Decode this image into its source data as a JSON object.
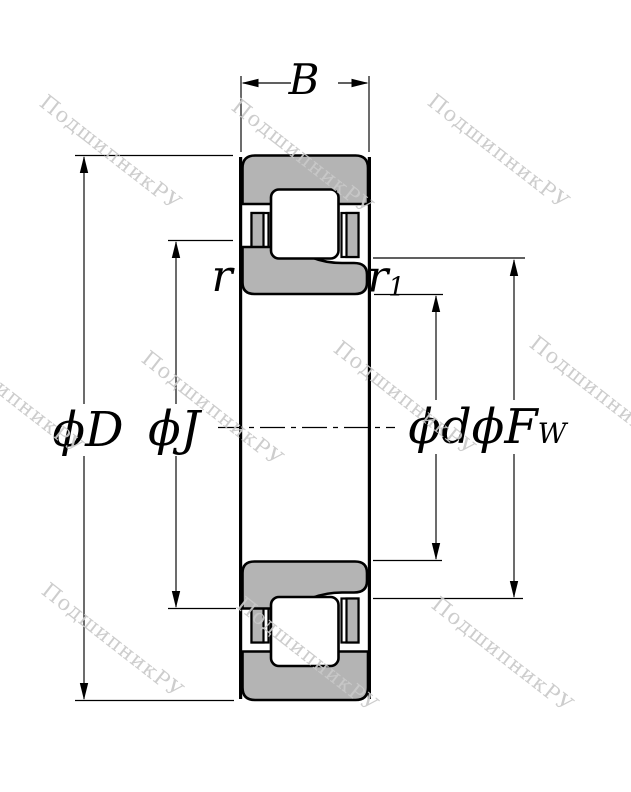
{
  "diagram": {
    "type": "cylindrical-roller-bearing-cross-section",
    "dimension_labels": {
      "width": "B",
      "outer_diameter": "ϕD",
      "rib_diameter": "ϕJ",
      "bore_diameter": "ϕd",
      "roller_inscribed_diameter_main": "ϕF",
      "roller_inscribed_diameter_sub": "W",
      "chamfer": "r",
      "chamfer1_main": "r",
      "chamfer1_sub": "1"
    },
    "colors": {
      "background": "#ffffff",
      "ring_fill": "#b4b4b4",
      "line": "#000000",
      "watermark": "#c9c9c9"
    },
    "watermark": {
      "text": "ПодшипникРУ",
      "angle_deg": 38,
      "positions": [
        {
          "x": 50,
          "y": 90
        },
        {
          "x": 242,
          "y": 94
        },
        {
          "x": 438,
          "y": 89
        },
        {
          "x": -48,
          "y": 334
        },
        {
          "x": 152,
          "y": 346
        },
        {
          "x": 344,
          "y": 336
        },
        {
          "x": 540,
          "y": 331
        },
        {
          "x": 52,
          "y": 578
        },
        {
          "x": 247,
          "y": 592
        },
        {
          "x": 442,
          "y": 592
        }
      ]
    }
  }
}
